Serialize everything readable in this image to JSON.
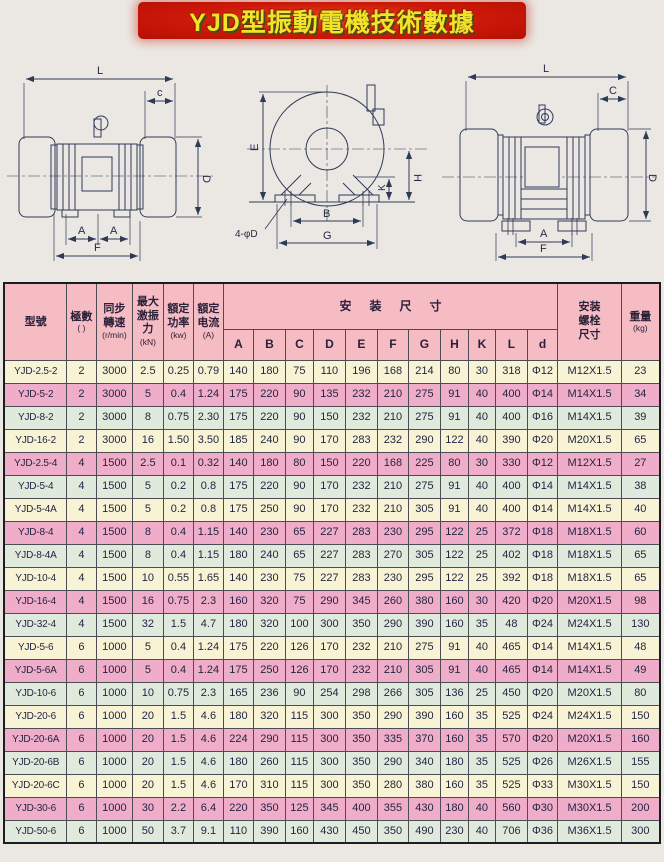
{
  "title": "YJD型振動電機技術數據",
  "diagrams": {
    "left": {
      "l": "L",
      "c": "c",
      "d": "D",
      "a1": "A",
      "a2": "A",
      "f": "F"
    },
    "front": {
      "e": "E",
      "k": "K",
      "h": "H",
      "b": "B",
      "g": "G",
      "holes": "4-φD"
    },
    "right": {
      "l": "L",
      "c": "C",
      "d": "D",
      "a": "A",
      "f": "F"
    }
  },
  "table": {
    "headers": {
      "model": "型號",
      "poles": "極數",
      "poles_sub": "(  )",
      "speed": "同步轉速",
      "speed_unit": "(r/min)",
      "force": "最大激振力",
      "force_unit": "(kN)",
      "power": "額定功率",
      "power_unit": "(kw)",
      "current": "額定电流",
      "current_unit": "(A)",
      "dims_group": "安装尺寸",
      "dims": [
        "A",
        "B",
        "C",
        "D",
        "E",
        "F",
        "G",
        "H",
        "K",
        "L",
        "d"
      ],
      "bolt": "安装螺栓尺寸",
      "weight": "重量",
      "weight_unit": "(kg)"
    },
    "rows": [
      {
        "model": "YJD-2.5-2",
        "color": "yellow",
        "values": [
          "2",
          "3000",
          "2.5",
          "0.25",
          "0.79",
          "140",
          "180",
          "75",
          "110",
          "196",
          "168",
          "214",
          "80",
          "30",
          "318",
          "Φ12",
          "M12X1.5",
          "23"
        ]
      },
      {
        "model": "YJD-5-2",
        "color": "pink",
        "values": [
          "2",
          "3000",
          "5",
          "0.4",
          "1.24",
          "175",
          "220",
          "90",
          "135",
          "232",
          "210",
          "275",
          "91",
          "40",
          "400",
          "Φ14",
          "M14X1.5",
          "34"
        ]
      },
      {
        "model": "YJD-8-2",
        "color": "green",
        "values": [
          "2",
          "3000",
          "8",
          "0.75",
          "2.30",
          "175",
          "220",
          "90",
          "150",
          "232",
          "210",
          "275",
          "91",
          "40",
          "400",
          "Φ16",
          "M14X1.5",
          "39"
        ]
      },
      {
        "model": "YJD-16-2",
        "color": "yellow",
        "values": [
          "2",
          "3000",
          "16",
          "1.50",
          "3.50",
          "185",
          "240",
          "90",
          "170",
          "283",
          "232",
          "290",
          "122",
          "40",
          "390",
          "Φ20",
          "M20X1.5",
          "65"
        ]
      },
      {
        "model": "YJD-2.5-4",
        "color": "pink",
        "values": [
          "4",
          "1500",
          "2.5",
          "0.1",
          "0.32",
          "140",
          "180",
          "80",
          "150",
          "220",
          "168",
          "225",
          "80",
          "30",
          "330",
          "Φ12",
          "M12X1.5",
          "27"
        ]
      },
      {
        "model": "YJD-5-4",
        "color": "green",
        "values": [
          "4",
          "1500",
          "5",
          "0.2",
          "0.8",
          "175",
          "220",
          "90",
          "170",
          "232",
          "210",
          "275",
          "91",
          "40",
          "400",
          "Φ14",
          "M14X1.5",
          "38"
        ]
      },
      {
        "model": "YJD-5-4A",
        "color": "yellow",
        "values": [
          "4",
          "1500",
          "5",
          "0.2",
          "0.8",
          "175",
          "250",
          "90",
          "170",
          "232",
          "210",
          "305",
          "91",
          "40",
          "400",
          "Φ14",
          "M14X1.5",
          "40"
        ]
      },
      {
        "model": "YJD-8-4",
        "color": "pink",
        "values": [
          "4",
          "1500",
          "8",
          "0.4",
          "1.15",
          "140",
          "230",
          "65",
          "227",
          "283",
          "230",
          "295",
          "122",
          "25",
          "372",
          "Φ18",
          "M18X1.5",
          "60"
        ]
      },
      {
        "model": "YJD-8-4A",
        "color": "green",
        "values": [
          "4",
          "1500",
          "8",
          "0.4",
          "1.15",
          "180",
          "240",
          "65",
          "227",
          "283",
          "270",
          "305",
          "122",
          "25",
          "402",
          "Φ18",
          "M18X1.5",
          "65"
        ]
      },
      {
        "model": "YJD-10-4",
        "color": "yellow",
        "values": [
          "4",
          "1500",
          "10",
          "0.55",
          "1.65",
          "140",
          "230",
          "75",
          "227",
          "283",
          "230",
          "295",
          "122",
          "25",
          "392",
          "Φ18",
          "M18X1.5",
          "65"
        ]
      },
      {
        "model": "YJD-16-4",
        "color": "pink",
        "values": [
          "4",
          "1500",
          "16",
          "0.75",
          "2.3",
          "160",
          "320",
          "75",
          "290",
          "345",
          "260",
          "380",
          "160",
          "30",
          "420",
          "Φ20",
          "M20X1.5",
          "98"
        ]
      },
      {
        "model": "YJD-32-4",
        "color": "green",
        "values": [
          "4",
          "1500",
          "32",
          "1.5",
          "4.7",
          "180",
          "320",
          "100",
          "300",
          "350",
          "290",
          "390",
          "160",
          "35",
          "48",
          "Φ24",
          "M24X1.5",
          "130"
        ]
      },
      {
        "model": "YJD-5-6",
        "color": "yellow",
        "values": [
          "6",
          "1000",
          "5",
          "0.4",
          "1.24",
          "175",
          "220",
          "126",
          "170",
          "232",
          "210",
          "275",
          "91",
          "40",
          "465",
          "Φ14",
          "M14X1.5",
          "48"
        ]
      },
      {
        "model": "YJD-5-6A",
        "color": "pink",
        "values": [
          "6",
          "1000",
          "5",
          "0.4",
          "1.24",
          "175",
          "250",
          "126",
          "170",
          "232",
          "210",
          "305",
          "91",
          "40",
          "465",
          "Φ14",
          "M14X1.5",
          "49"
        ]
      },
      {
        "model": "YJD-10-6",
        "color": "green",
        "values": [
          "6",
          "1000",
          "10",
          "0.75",
          "2.3",
          "165",
          "236",
          "90",
          "254",
          "298",
          "266",
          "305",
          "136",
          "25",
          "450",
          "Φ20",
          "M20X1.5",
          "80"
        ]
      },
      {
        "model": "YJD-20-6",
        "color": "yellow",
        "values": [
          "6",
          "1000",
          "20",
          "1.5",
          "4.6",
          "180",
          "320",
          "115",
          "300",
          "350",
          "290",
          "390",
          "160",
          "35",
          "525",
          "Φ24",
          "M24X1.5",
          "150"
        ]
      },
      {
        "model": "YJD-20-6A",
        "color": "pink",
        "values": [
          "6",
          "1000",
          "20",
          "1.5",
          "4.6",
          "224",
          "290",
          "115",
          "300",
          "350",
          "335",
          "370",
          "160",
          "35",
          "570",
          "Φ20",
          "M20X1.5",
          "160"
        ]
      },
      {
        "model": "YJD-20-6B",
        "color": "green",
        "values": [
          "6",
          "1000",
          "20",
          "1.5",
          "4.6",
          "180",
          "260",
          "115",
          "300",
          "350",
          "290",
          "340",
          "180",
          "35",
          "525",
          "Φ26",
          "M26X1.5",
          "155"
        ]
      },
      {
        "model": "YJD-20-6C",
        "color": "yellow",
        "values": [
          "6",
          "1000",
          "20",
          "1.5",
          "4.6",
          "170",
          "310",
          "115",
          "300",
          "350",
          "280",
          "380",
          "160",
          "35",
          "525",
          "Φ33",
          "M30X1.5",
          "150"
        ]
      },
      {
        "model": "YJD-30-6",
        "color": "pink",
        "values": [
          "6",
          "1000",
          "30",
          "2.2",
          "6.4",
          "220",
          "350",
          "125",
          "345",
          "400",
          "355",
          "430",
          "180",
          "40",
          "560",
          "Φ30",
          "M30X1.5",
          "200"
        ]
      },
      {
        "model": "YJD-50-6",
        "color": "green",
        "values": [
          "6",
          "1000",
          "50",
          "3.7",
          "9.1",
          "110",
          "390",
          "160",
          "430",
          "450",
          "350",
          "490",
          "230",
          "40",
          "706",
          "Φ36",
          "M36X1.5",
          "300"
        ]
      }
    ]
  }
}
